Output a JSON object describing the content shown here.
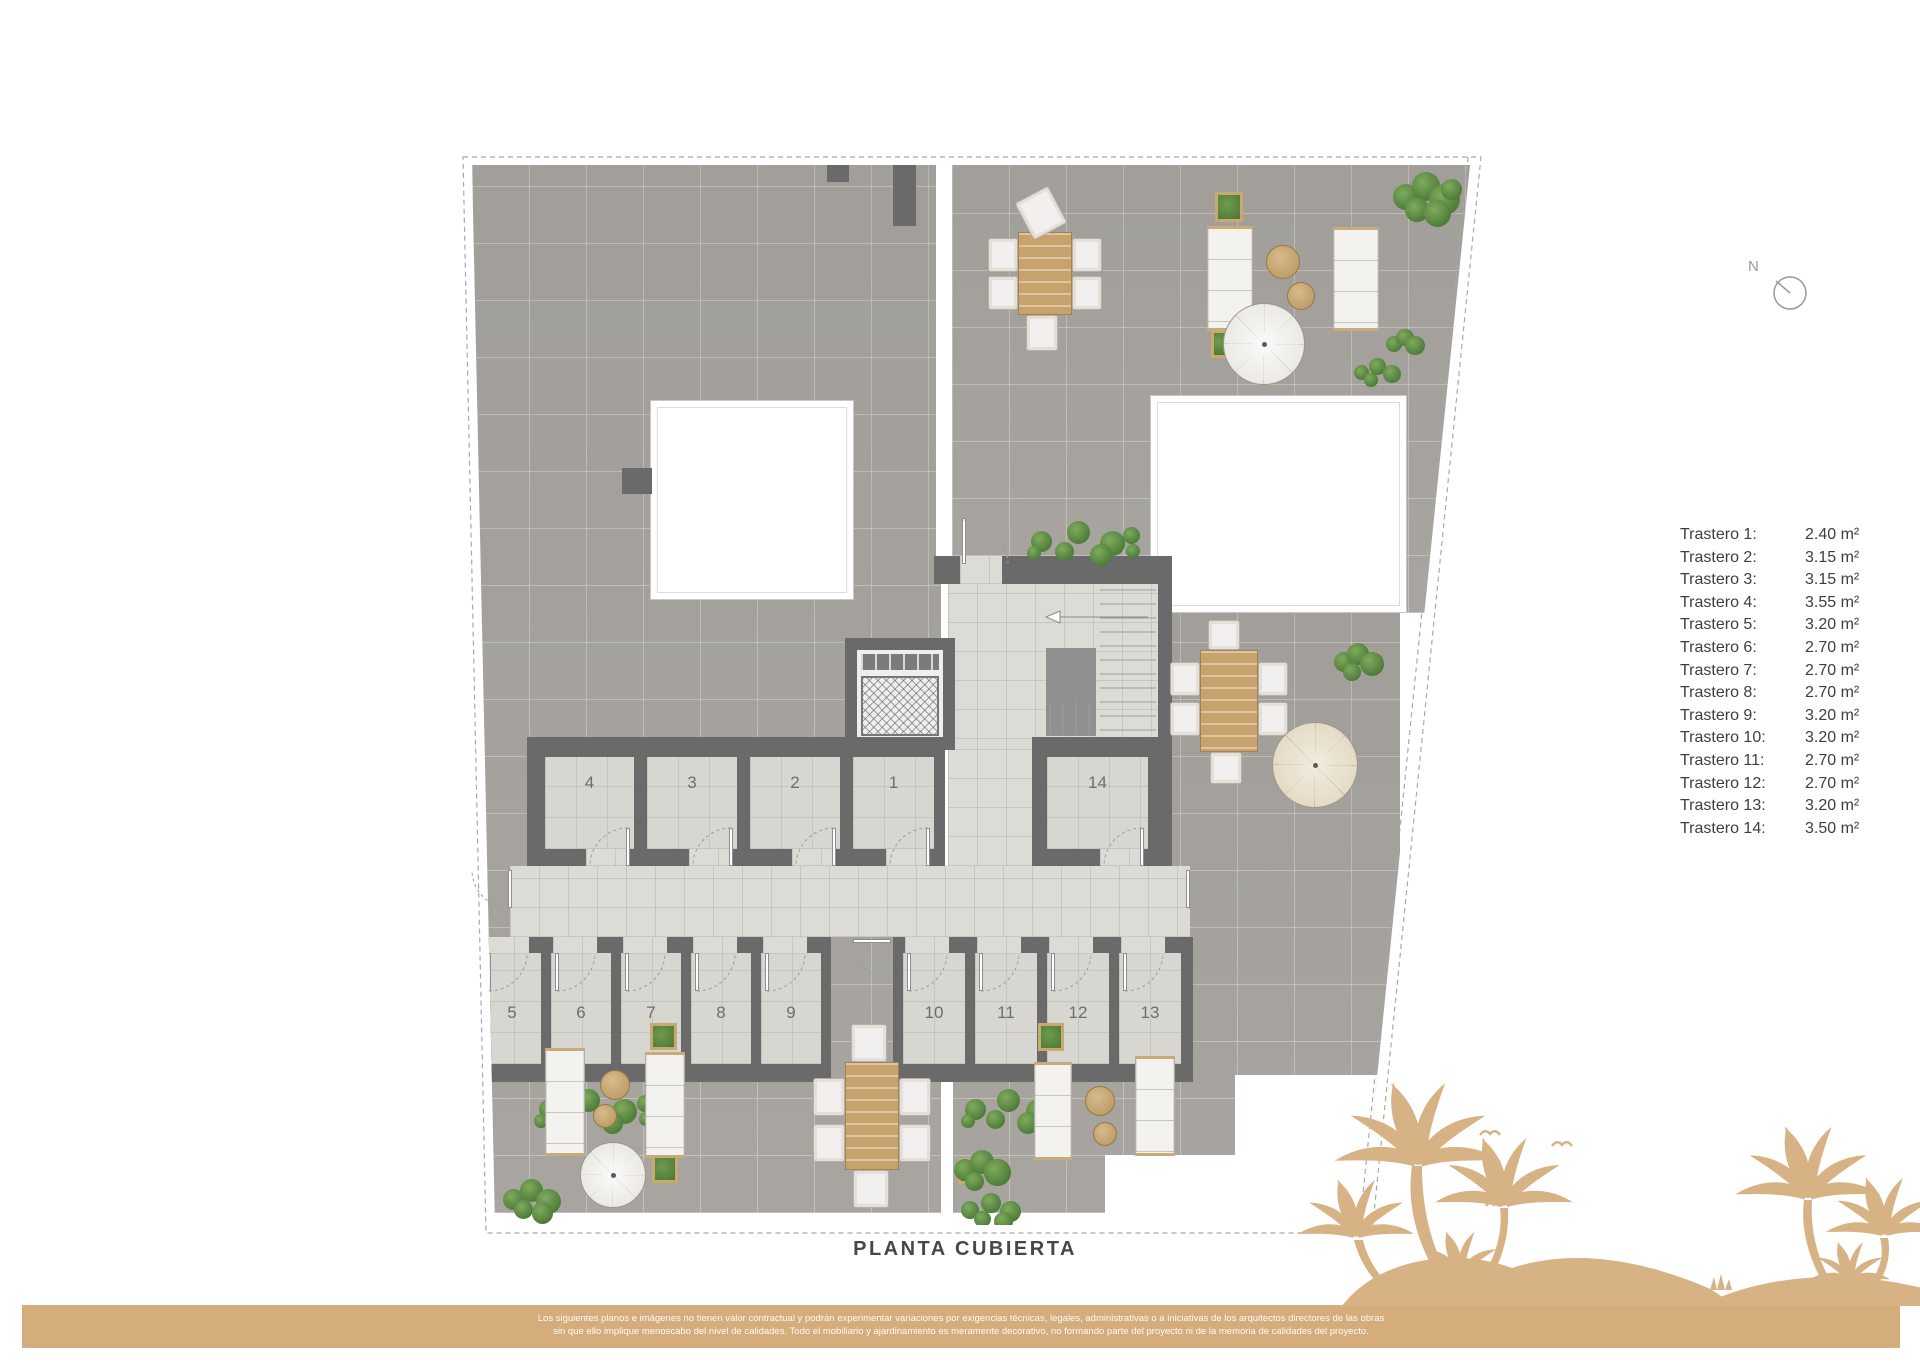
{
  "title": "PLANTA CUBIERTA",
  "north": {
    "label": "N"
  },
  "legend": {
    "items": [
      {
        "label": "Trastero 1:",
        "value": "2.40 m²"
      },
      {
        "label": "Trastero 2:",
        "value": "3.15 m²"
      },
      {
        "label": "Trastero 3:",
        "value": "3.15 m²"
      },
      {
        "label": "Trastero 4:",
        "value": "3.55 m²"
      },
      {
        "label": "Trastero 5:",
        "value": "3.20 m²"
      },
      {
        "label": "Trastero 6:",
        "value": "2.70 m²"
      },
      {
        "label": "Trastero 7:",
        "value": "2.70 m²"
      },
      {
        "label": "Trastero 8:",
        "value": "2.70 m²"
      },
      {
        "label": "Trastero 9:",
        "value": "3.20 m²"
      },
      {
        "label": "Trastero 10:",
        "value": "3.20 m²"
      },
      {
        "label": "Trastero 11:",
        "value": "2.70 m²"
      },
      {
        "label": "Trastero 12:",
        "value": "2.70 m²"
      },
      {
        "label": "Trastero 13:",
        "value": "3.20 m²"
      },
      {
        "label": "Trastero 14:",
        "value": "3.50 m²"
      }
    ]
  },
  "plan": {
    "room_labels": [
      "1",
      "2",
      "3",
      "4",
      "5",
      "6",
      "7",
      "8",
      "9",
      "10",
      "11",
      "12",
      "13",
      "14"
    ]
  },
  "footer": {
    "line1": "Los siguientes planos e imágenes no tienen valor contractual y podrán experimentar variaciones por exigencias técnicas, legales, administrativas o a iniciativas de los arquitectos directores de las obras",
    "line2": "sin que ello implique menoscabo del nivel de calidades. Todo el mobiliario y ajardinamiento es meramente decorativo, no formando parte del proyecto ni de la memoria de calidades del proyecto."
  },
  "colors": {
    "tan": "#d5ad7c",
    "wall_gray": "#6a6a6a",
    "terrace_gray": "#a8a5a0",
    "light_floor": "#dddbd6",
    "plant_green": "#55803e",
    "wood": "#c7a26c"
  }
}
